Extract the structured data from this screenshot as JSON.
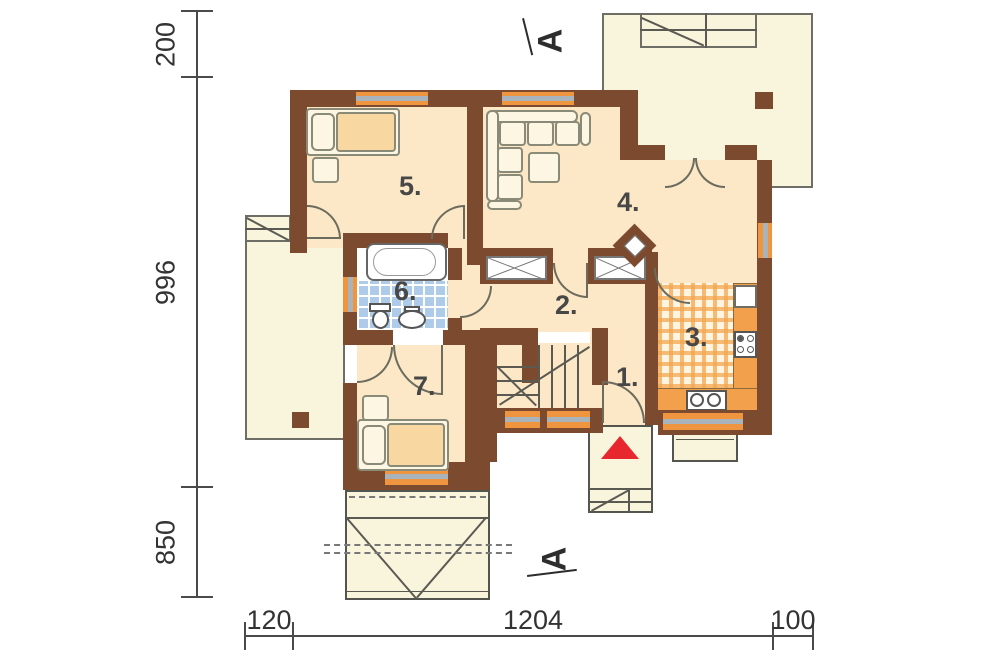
{
  "drawing": {
    "type": "architectural-floor-plan",
    "rooms": [
      {
        "label": "1."
      },
      {
        "label": "2."
      },
      {
        "label": "3."
      },
      {
        "label": "4."
      },
      {
        "label": "5."
      },
      {
        "label": "6."
      },
      {
        "label": "7."
      }
    ],
    "section_markers": {
      "top": "A",
      "bottom": "A"
    },
    "dimensions": {
      "left": [
        "200",
        "996",
        "850"
      ],
      "bottom": [
        "120",
        "1204",
        "100"
      ]
    },
    "colors": {
      "wall": "#7b4a2f",
      "room_floor": "#fce8c6",
      "outdoor_floor": "#f9f4dc",
      "window_frame": "#f0953f",
      "window_glass": "#a9b3bc",
      "bath_tile": "#aecbe9",
      "kitchen_tile": "#f3a64f",
      "entrance_arrow": "#e8262e"
    }
  }
}
